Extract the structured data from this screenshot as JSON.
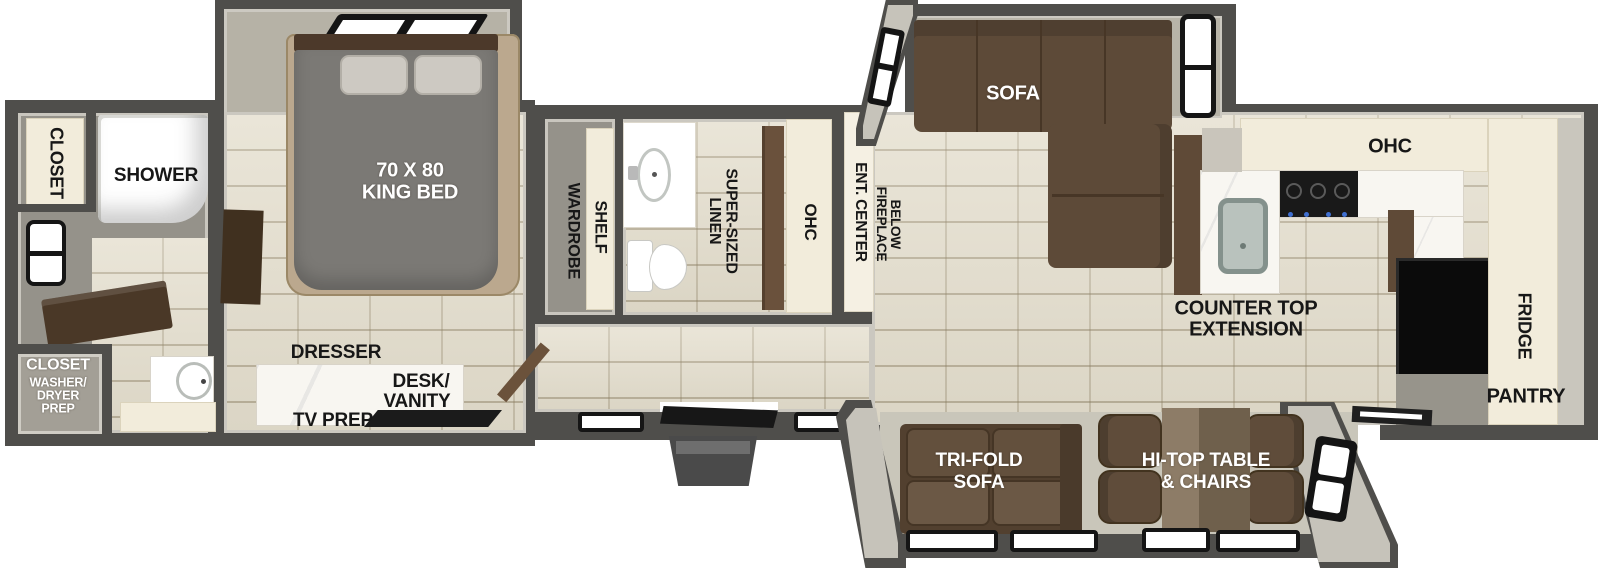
{
  "rooms": {
    "rear_bath": {
      "closet": "CLOSET",
      "shower": "SHOWER",
      "washer_closet_lines": [
        "CLOSET",
        "WASHER/",
        "DRYER",
        "PREP"
      ]
    },
    "bedroom": {
      "bed_lines": [
        "70 X 80",
        "KING BED"
      ],
      "dresser": "DRESSER",
      "desk_vanity_lines": [
        "DESK/",
        "VANITY"
      ],
      "tv_prep": "TV PREP"
    },
    "mid_bath": {
      "wardrobe": "WARDROBE",
      "shelf": "SHELF",
      "linen_lines": [
        "SUPER-SIZED",
        "LINEN"
      ],
      "ohc": "OHC"
    },
    "living": {
      "ent_center": "ENT. CENTER",
      "fireplace_lines": [
        "FIREPLACE",
        "BELOW"
      ],
      "sofa": "SOFA"
    },
    "kitchen": {
      "ohc": "OHC",
      "counter_extension_lines": [
        "COUNTER TOP",
        "EXTENSION"
      ],
      "fridge": "FRIDGE",
      "pantry": "PANTRY"
    },
    "rear_living": {
      "trifold_lines": [
        "TRI-FOLD",
        "SOFA"
      ],
      "hitop_lines": [
        "HI-TOP TABLE",
        "& CHAIRS"
      ]
    }
  },
  "colors": {
    "wall": "#4f4e4b",
    "wall_liner": "#c9c6bd",
    "tile_floor": "#e4decd",
    "gray_floor": "#95928a",
    "cabinet_cream": "#f2ecdb",
    "sofa_brown": "#5d4a38",
    "wood_dark": "#4a3827",
    "marble": "#f8f6f1",
    "label_text": "#171717",
    "window_pane": "#ffffff"
  }
}
